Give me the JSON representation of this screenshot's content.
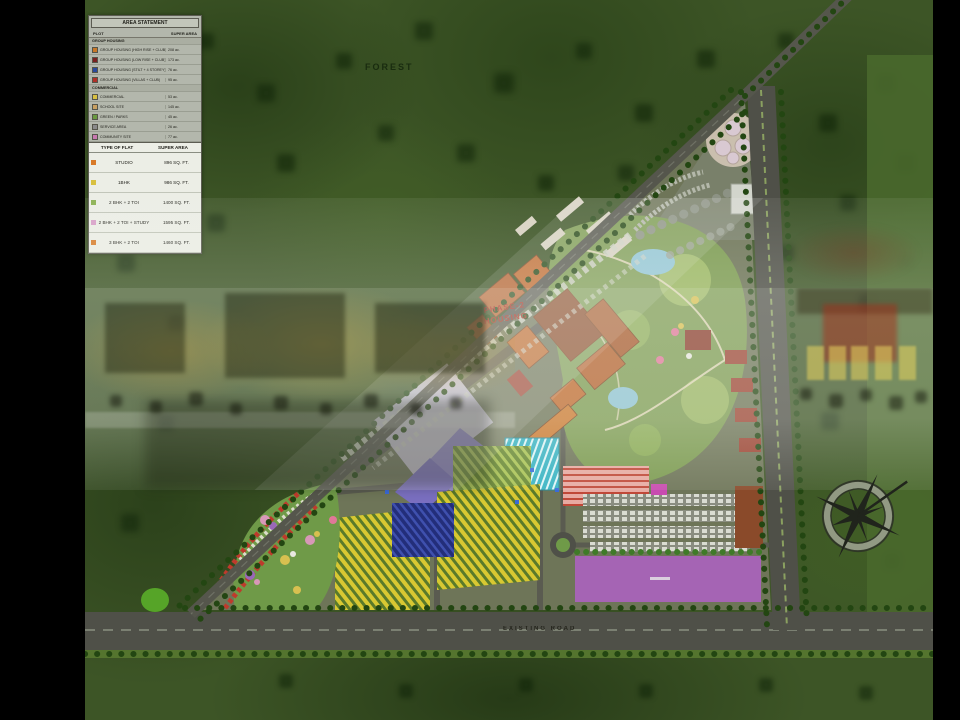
{
  "labels": {
    "forest": "FOREST",
    "phase_line1": "PHASE-2",
    "phase_line2": "HOUSING",
    "bottom_road": "EXISTING ROAD"
  },
  "legend": {
    "area_statement": {
      "title": "AREA STATEMENT",
      "columns": [
        "PLOT",
        "SUPER AREA"
      ],
      "groups": [
        {
          "heading": "GROUP HOUSING",
          "rows": [
            {
              "chip": "#c87828",
              "label": "GROUP HOUSING (HIGH RISE + CLUB)",
              "value": "208 ac."
            },
            {
              "chip": "#7a2020",
              "label": "GROUP HOUSING (LOW RISE + CLUB)",
              "value": "173 ac."
            },
            {
              "chip": "#2a4a9c",
              "label": "GROUP HOUSING (STILT + 4 STOREY)",
              "value": "76 ac."
            },
            {
              "chip": "#b03028",
              "label": "GROUP HOUSING (VILLAS + CLUB)",
              "value": "95 ac."
            }
          ]
        },
        {
          "heading": "COMMERCIAL",
          "rows": [
            {
              "chip": "#d8c040",
              "label": "COMMERCIAL",
              "value": "53 ac."
            },
            {
              "chip": "#c8a060",
              "label": "SCHOOL SITE",
              "value": "145 ac."
            },
            {
              "chip": "#6a9a40",
              "label": "GREEN / PARKS",
              "value": "45 ac."
            },
            {
              "chip": "#8a8a8a",
              "label": "SERVICE AREA",
              "value": "26 ac."
            },
            {
              "chip": "#c878b0",
              "label": "COMMUNITY SITE",
              "value": "77 ac."
            }
          ]
        }
      ]
    },
    "flats": {
      "header": [
        "TYPE OF FLAT",
        "SUPER AREA"
      ],
      "rows": [
        {
          "chip": "#d87a28",
          "label": "STUDIO",
          "value": "896 SQ. FT."
        },
        {
          "chip": "#d8c040",
          "label": "1BHK",
          "value": "986 SQ. FT."
        },
        {
          "chip": "#8ab050",
          "label": "2 BHK + 2 TOI",
          "value": "1400 SQ. FT."
        },
        {
          "chip": "#d8a0c8",
          "label": "2 BHK + 2 TOI + STUDY",
          "value": "1595 SQ. FT."
        },
        {
          "chip": "#d88030",
          "label": "3 BHK + 2 TOI",
          "value": "1460 SQ. FT."
        }
      ]
    }
  },
  "colors": {
    "letterbox": "#000000",
    "ground_green": "#3d5526",
    "road_grey": "#4f5048",
    "site_olive": "#6e7558",
    "park_green": "#7d9c52",
    "water_blue": "#8ec4d4",
    "yellow_housing": "#d8c832",
    "navy_housing": "#232e7a",
    "teal_block": "#38b4c4",
    "purple_block": "#8f84c8",
    "commercial_purple": "#a564b4",
    "orange_block": "#b5622e",
    "pink_rows": "#e8aaa2",
    "overlay_white": "#f2f4ee",
    "phase_label_red": "#a8281a"
  }
}
